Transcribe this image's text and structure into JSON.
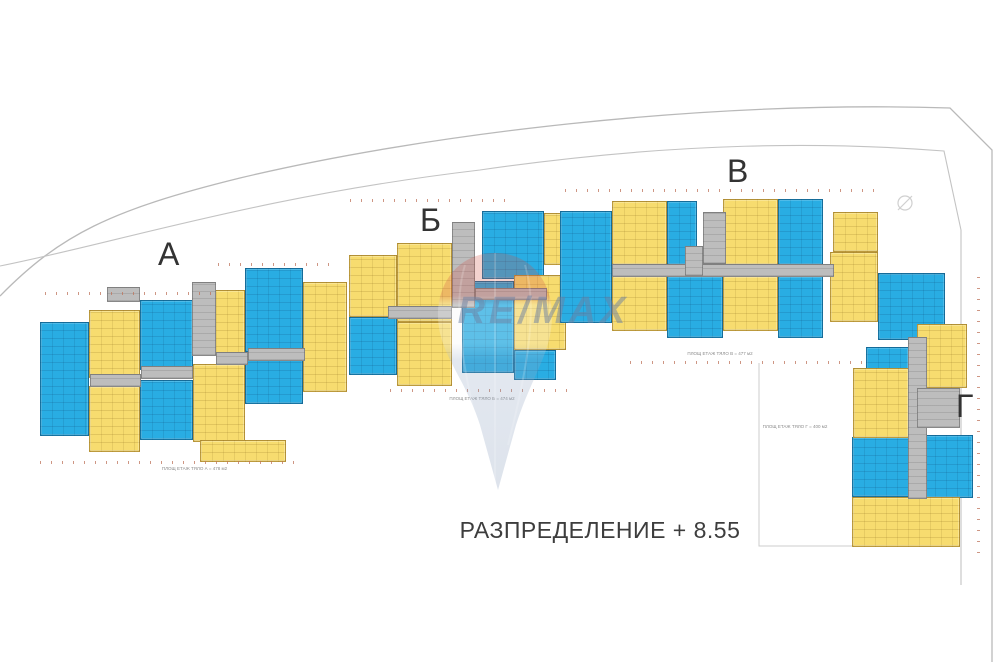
{
  "title": "РАЗПРЕДЕЛЕНИЕ + 8.55",
  "watermark_text": "RE/MAX",
  "colors": {
    "blue": "#29ade3",
    "yellow": "#f7dc6f",
    "corridor": "#bdbdbd"
  },
  "sections": [
    {
      "id": "a",
      "label": "А",
      "area_label": "ПЛОЩ ЕТАЖ ТЯЛО А = 478 м2",
      "label_pos": {
        "x": 158,
        "y": 238
      },
      "area_pos": {
        "x": 147,
        "y": 466,
        "w": 95
      },
      "blocks": [
        {
          "x": 40,
          "y": 322,
          "w": 49,
          "h": 114,
          "c": "blue"
        },
        {
          "x": 140,
          "y": 300,
          "w": 53,
          "h": 70,
          "c": "blue"
        },
        {
          "x": 140,
          "y": 380,
          "w": 53,
          "h": 60,
          "c": "blue"
        },
        {
          "x": 245,
          "y": 268,
          "w": 58,
          "h": 84,
          "c": "blue"
        },
        {
          "x": 245,
          "y": 358,
          "w": 58,
          "h": 46,
          "c": "blue"
        },
        {
          "x": 89,
          "y": 310,
          "w": 51,
          "h": 68,
          "c": "yellow"
        },
        {
          "x": 89,
          "y": 386,
          "w": 51,
          "h": 66,
          "c": "yellow"
        },
        {
          "x": 193,
          "y": 290,
          "w": 52,
          "h": 66,
          "c": "yellow"
        },
        {
          "x": 193,
          "y": 364,
          "w": 52,
          "h": 78,
          "c": "yellow"
        },
        {
          "x": 200,
          "y": 440,
          "w": 86,
          "h": 22,
          "c": "yellow"
        },
        {
          "x": 303,
          "y": 282,
          "w": 44,
          "h": 110,
          "c": "yellow"
        },
        {
          "x": 107,
          "y": 287,
          "w": 33,
          "h": 15,
          "c": "gray"
        },
        {
          "x": 192,
          "y": 282,
          "w": 24,
          "h": 74,
          "c": "gray"
        },
        {
          "x": 90,
          "y": 374,
          "w": 51,
          "h": 13,
          "c": "gray"
        },
        {
          "x": 141,
          "y": 366,
          "w": 52,
          "h": 13,
          "c": "gray"
        },
        {
          "x": 216,
          "y": 352,
          "w": 32,
          "h": 13,
          "c": "gray"
        },
        {
          "x": 248,
          "y": 348,
          "w": 57,
          "h": 13,
          "c": "gray"
        }
      ],
      "ticks": [
        {
          "x": 45,
          "y": 292,
          "w": 170
        },
        {
          "x": 40,
          "y": 461,
          "w": 262
        },
        {
          "x": 218,
          "y": 263,
          "w": 120
        }
      ]
    },
    {
      "id": "b",
      "label": "Б",
      "area_label": "ПЛОЩ ЕТАЖ ТЯЛО Б = 474 м2",
      "label_pos": {
        "x": 420,
        "y": 204
      },
      "area_pos": {
        "x": 437,
        "y": 396,
        "w": 90
      },
      "blocks": [
        {
          "x": 482,
          "y": 211,
          "w": 62,
          "h": 68,
          "c": "blue"
        },
        {
          "x": 349,
          "y": 317,
          "w": 48,
          "h": 58,
          "c": "blue"
        },
        {
          "x": 462,
          "y": 281,
          "w": 52,
          "h": 92,
          "c": "blue"
        },
        {
          "x": 514,
          "y": 350,
          "w": 42,
          "h": 30,
          "c": "blue"
        },
        {
          "x": 349,
          "y": 255,
          "w": 48,
          "h": 62,
          "c": "yellow"
        },
        {
          "x": 397,
          "y": 243,
          "w": 55,
          "h": 79,
          "c": "yellow"
        },
        {
          "x": 397,
          "y": 322,
          "w": 55,
          "h": 64,
          "c": "yellow"
        },
        {
          "x": 514,
          "y": 275,
          "w": 52,
          "h": 75,
          "c": "yellow"
        },
        {
          "x": 544,
          "y": 213,
          "w": 32,
          "h": 52,
          "c": "yellow"
        },
        {
          "x": 452,
          "y": 222,
          "w": 23,
          "h": 86,
          "c": "gray"
        },
        {
          "x": 388,
          "y": 306,
          "w": 64,
          "h": 13,
          "c": "gray"
        },
        {
          "x": 475,
          "y": 288,
          "w": 72,
          "h": 12,
          "c": "gray"
        }
      ],
      "ticks": [
        {
          "x": 350,
          "y": 199,
          "w": 160
        },
        {
          "x": 390,
          "y": 389,
          "w": 178
        }
      ]
    },
    {
      "id": "v",
      "label": "В",
      "area_label": "ПЛОЩ ЕТАЖ ТЯЛО В = 477 м2",
      "label_pos": {
        "x": 727,
        "y": 155
      },
      "area_pos": {
        "x": 675,
        "y": 351,
        "w": 90
      },
      "blocks": [
        {
          "x": 560,
          "y": 211,
          "w": 52,
          "h": 112,
          "c": "blue"
        },
        {
          "x": 667,
          "y": 201,
          "w": 30,
          "h": 64,
          "c": "blue"
        },
        {
          "x": 778,
          "y": 199,
          "w": 45,
          "h": 66,
          "c": "blue"
        },
        {
          "x": 667,
          "y": 276,
          "w": 56,
          "h": 62,
          "c": "blue"
        },
        {
          "x": 778,
          "y": 276,
          "w": 45,
          "h": 62,
          "c": "blue"
        },
        {
          "x": 612,
          "y": 201,
          "w": 55,
          "h": 64,
          "c": "yellow"
        },
        {
          "x": 723,
          "y": 199,
          "w": 55,
          "h": 66,
          "c": "yellow"
        },
        {
          "x": 833,
          "y": 212,
          "w": 45,
          "h": 40,
          "c": "yellow"
        },
        {
          "x": 612,
          "y": 276,
          "w": 55,
          "h": 55,
          "c": "yellow"
        },
        {
          "x": 723,
          "y": 276,
          "w": 55,
          "h": 55,
          "c": "yellow"
        },
        {
          "x": 830,
          "y": 252,
          "w": 48,
          "h": 70,
          "c": "yellow"
        },
        {
          "x": 612,
          "y": 264,
          "w": 222,
          "h": 13,
          "c": "gray"
        },
        {
          "x": 703,
          "y": 212,
          "w": 23,
          "h": 52,
          "c": "gray"
        },
        {
          "x": 685,
          "y": 246,
          "w": 18,
          "h": 30,
          "c": "gray"
        }
      ],
      "ticks": [
        {
          "x": 565,
          "y": 189,
          "w": 315
        },
        {
          "x": 630,
          "y": 361,
          "w": 250
        }
      ]
    },
    {
      "id": "g",
      "label": "Г",
      "area_label": "ПЛОЩ ЕТАЖ ТЯЛО Г = 400 м2",
      "label_pos": {
        "x": 956,
        "y": 390
      },
      "area_pos": {
        "x": 750,
        "y": 424,
        "w": 90
      },
      "blocks": [
        {
          "x": 878,
          "y": 273,
          "w": 67,
          "h": 67,
          "c": "blue"
        },
        {
          "x": 866,
          "y": 347,
          "w": 43,
          "h": 25,
          "c": "blue"
        },
        {
          "x": 852,
          "y": 437,
          "w": 60,
          "h": 60,
          "c": "blue"
        },
        {
          "x": 923,
          "y": 435,
          "w": 50,
          "h": 63,
          "c": "blue"
        },
        {
          "x": 917,
          "y": 324,
          "w": 50,
          "h": 64,
          "c": "yellow"
        },
        {
          "x": 853,
          "y": 368,
          "w": 56,
          "h": 70,
          "c": "yellow"
        },
        {
          "x": 852,
          "y": 497,
          "w": 108,
          "h": 50,
          "c": "yellow"
        },
        {
          "x": 908,
          "y": 337,
          "w": 19,
          "h": 162,
          "c": "gray"
        },
        {
          "x": 917,
          "y": 388,
          "w": 43,
          "h": 40,
          "c": "gray"
        }
      ],
      "ticks": [
        {
          "x": 977,
          "y": 275,
          "h": 278,
          "v": true
        }
      ]
    }
  ]
}
